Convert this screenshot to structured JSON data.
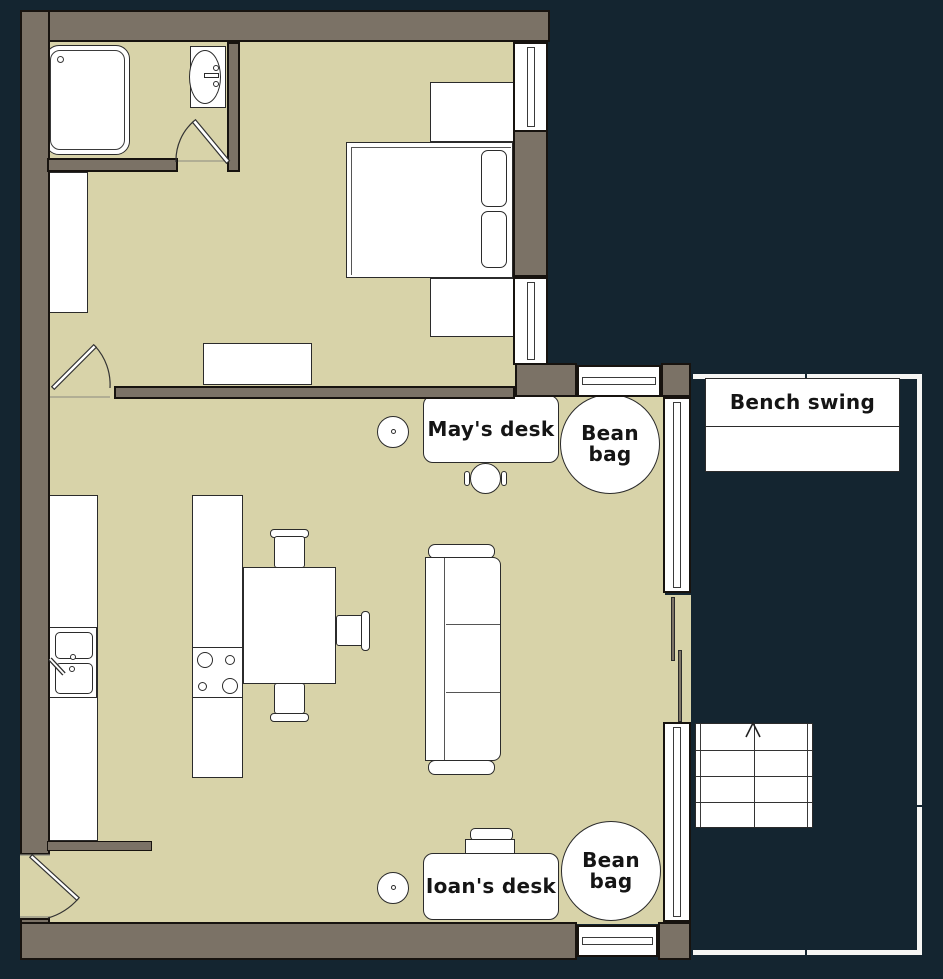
{
  "labels": {
    "may_desk": "May's desk",
    "ioan_desk": "Ioan's desk",
    "bean_bag": "Bean bag",
    "bench_swing": "Bench swing"
  },
  "colors": {
    "background": "#142530",
    "wall": "#7b7266",
    "floor": "#d8d3a9",
    "furniture": "#ffffff",
    "outline": "#1a1a1a"
  }
}
